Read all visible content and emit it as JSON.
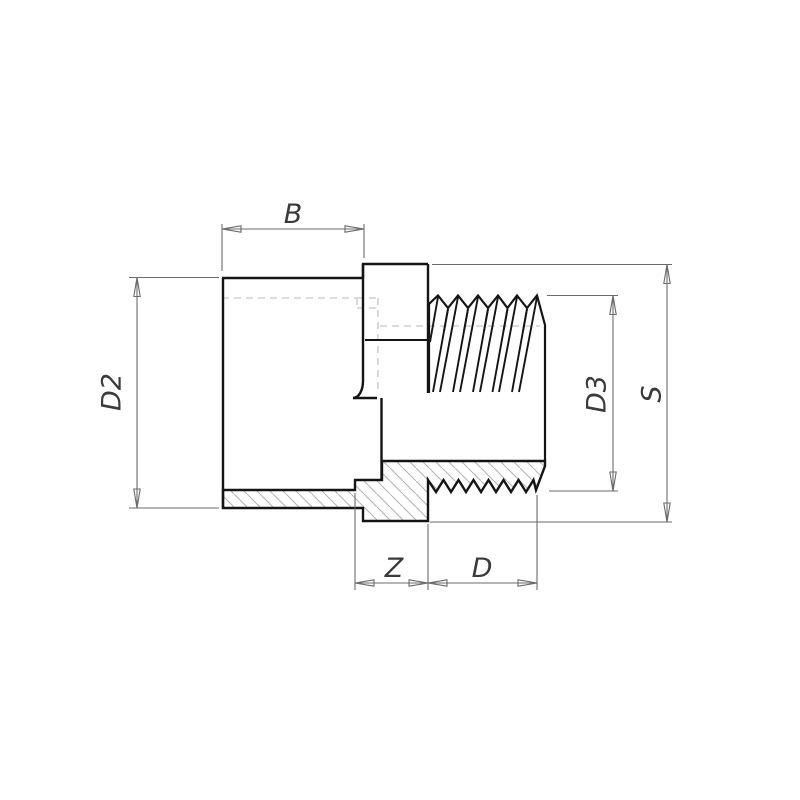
{
  "drawing": {
    "type": "technical-half-section",
    "subject": "PVC socket to male thread adapter fitting",
    "labels": {
      "socket_length": "B",
      "socket_outer_diameter": "D2",
      "thread_crest_diameter": "D3",
      "across_flats": "S",
      "engagement_length": "Z",
      "thread_length": "D"
    },
    "colors": {
      "outline": "#141414",
      "thin_line": "#6b6b6b",
      "hidden_line": "#c6c6c6",
      "hatch_line": "#b5b5b5",
      "centerline_red": "#e53935",
      "label_text": "#3a3a3a",
      "background": "#ffffff"
    }
  }
}
